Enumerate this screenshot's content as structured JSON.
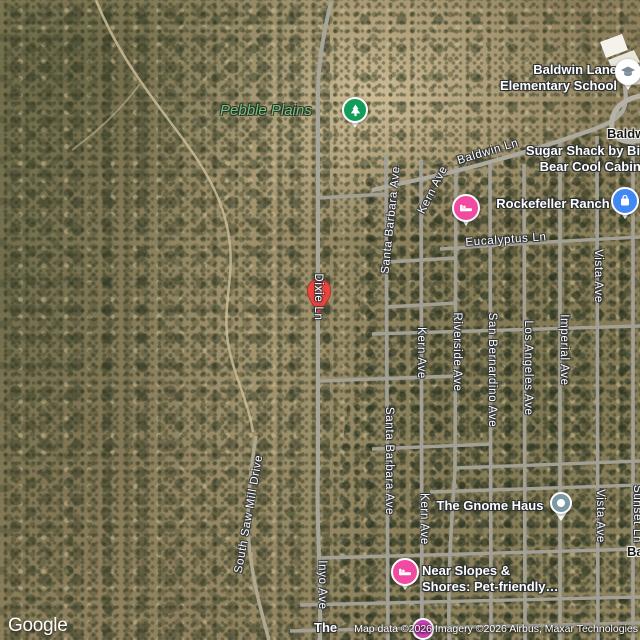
{
  "branding": {
    "logo": "Google",
    "attribution": "Map data ©2026 Imagery ©2026 Airbus, Maxar Technologies"
  },
  "park": {
    "label": "Pebble Plains",
    "label_color": "#74C27C",
    "pin_color": "#129D58"
  },
  "marker": {
    "label": "S",
    "color": "#E8453C"
  },
  "pois": [
    {
      "id": "baldwin-lane-elementary-school",
      "lines": [
        "Baldwin Lane",
        "Elementary School"
      ],
      "icon": "graduation-cap-icon",
      "pin_color": "#FFFFFF",
      "glyph_color": "#7E8C99"
    },
    {
      "id": "sugar-shack-by-big-bear-cool-cabins",
      "lines": [
        "Sugar Shack by Big",
        "Bear Cool Cabins"
      ]
    },
    {
      "id": "rockefeller-ranch",
      "lines": [
        "Rockefeller Ranch"
      ],
      "icon": "bed-icon",
      "pin_color": "#F04BA0"
    },
    {
      "id": "shopping-place",
      "lines": [],
      "icon": "shopping-bag-icon",
      "pin_color": "#4187F5"
    },
    {
      "id": "the-gnome-haus",
      "lines": [
        "The Gnome Haus"
      ],
      "icon": "dot-icon",
      "pin_color": "#7E98A6"
    },
    {
      "id": "near-slopes-and-shores",
      "lines": [
        "Near Slopes &",
        "Shores: Pet-friendly…"
      ],
      "icon": "bed-icon",
      "pin_color": "#F04BA0"
    },
    {
      "id": "partial-poi-bottom",
      "lines": [
        "The"
      ],
      "icon": "partial-pin",
      "pin_color": "#C943B5"
    }
  ],
  "streets": [
    "Baldwin Ln",
    "Eucalyptus Ln",
    "Santa Barbara Ave",
    "Kern Ave",
    "Dixie Ln",
    "Kern Ave",
    "Riverside Ave",
    "San Bernardino Ave",
    "Los Angeles Ave",
    "Imperial Ave",
    "Vista Ave",
    "Santa Barbara Ave",
    "Kern Ave",
    "South Saw Mill Drive",
    "Vista Ave",
    "Sunset Ln",
    "Inyo Ave"
  ],
  "clipped_place_labels": [
    "Baldw",
    "Ba"
  ],
  "colors": {
    "road": "#A3A096",
    "search_pin_red": "#E8453C",
    "lodging_pin_pink": "#F04BA0",
    "shopping_pin_blue": "#4187F5",
    "generic_pin_slate": "#7E98A6",
    "park_pin_green": "#129D58"
  }
}
